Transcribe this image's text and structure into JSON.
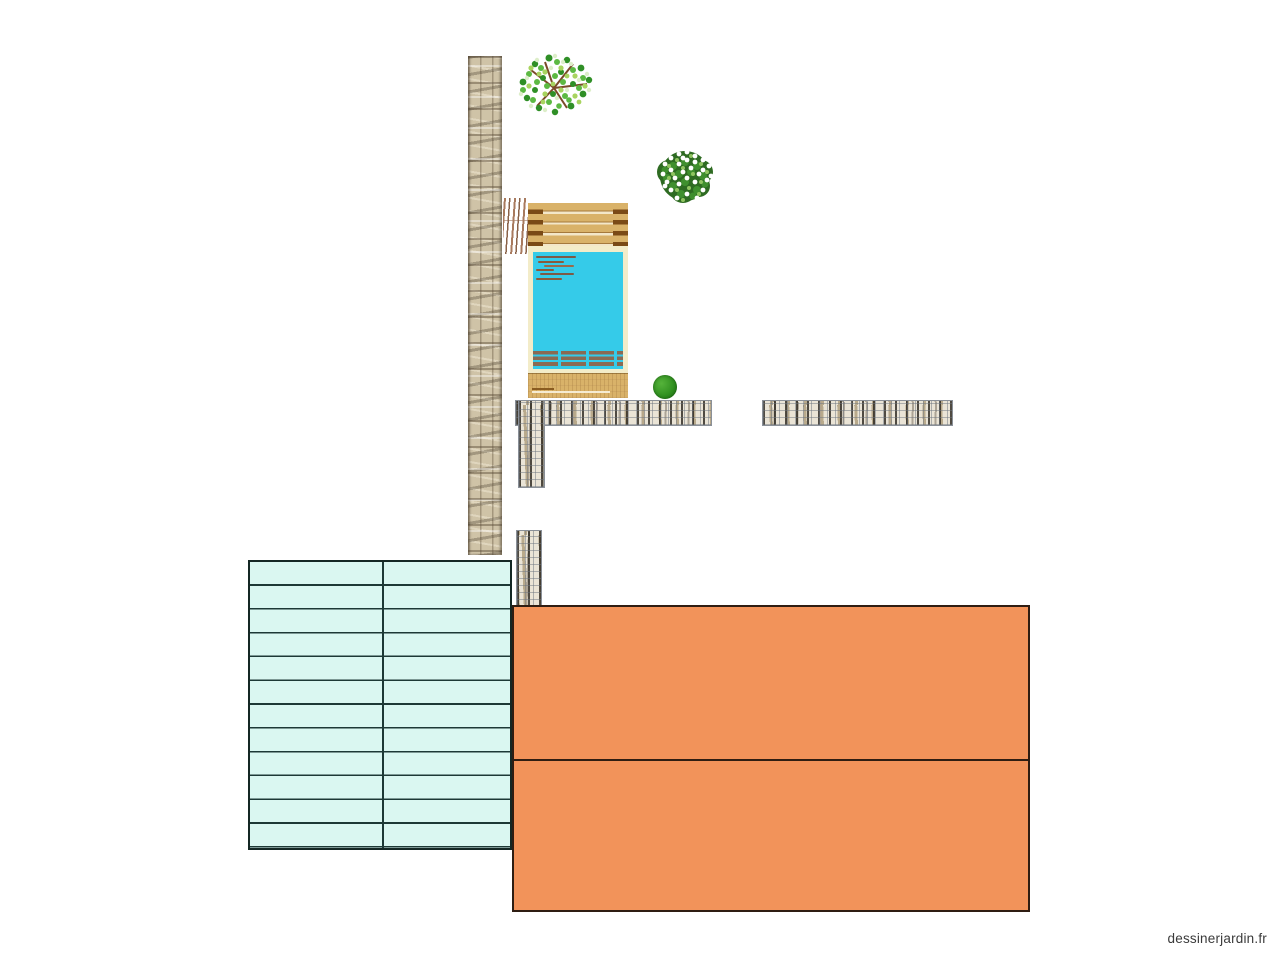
{
  "page": {
    "background": "#ffffff",
    "watermark": "dessinerjardin.fr"
  },
  "palette": {
    "orange_fill": "#f2935a",
    "orange_border": "#2f1d12",
    "mint_fill": "#daf7f1",
    "mint_line": "#1d3936",
    "pool_water": "#35cbe9",
    "pool_frame": "#f3ecc9",
    "deck_wood": "#d9b269",
    "deck_wood_dark": "#7a4a16",
    "gabion_stone": "#eae4d6",
    "gabion_mesh": "#8a9098",
    "stone_wall": "#cfc3a7",
    "tree_green": "#2f8f26",
    "shrub_green": "#2e6b22",
    "flower_white": "#ffffff",
    "bush_green": "#2f8f1f",
    "reed_brown": "#a87a5e",
    "watermark_text": "#3a3a3a"
  },
  "plan": {
    "objects": [
      {
        "id": "stone-wall",
        "kind": "dry-stone-wall-vertical"
      },
      {
        "id": "deciduous-tree",
        "kind": "tree-top-view"
      },
      {
        "id": "flowering-shrub",
        "kind": "shrub-white-flowers-top-view"
      },
      {
        "id": "reed-screen",
        "kind": "branch-screen"
      },
      {
        "id": "deck-top",
        "kind": "wood-deck"
      },
      {
        "id": "pool",
        "kind": "swimming-pool"
      },
      {
        "id": "deck-bottom",
        "kind": "wood-deck"
      },
      {
        "id": "boxwood-ball",
        "kind": "small-round-bush"
      },
      {
        "id": "gabion-left-horizontal",
        "kind": "gabion-wall"
      },
      {
        "id": "gabion-right-horizontal",
        "kind": "gabion-wall"
      },
      {
        "id": "gabion-vertical-upper",
        "kind": "gabion-wall"
      },
      {
        "id": "gabion-vertical-lower",
        "kind": "gabion-wall"
      },
      {
        "id": "plank-terrace",
        "kind": "decking-grid-2x12"
      },
      {
        "id": "terrace-upper",
        "kind": "orange-terrace"
      },
      {
        "id": "terrace-lower",
        "kind": "orange-terrace"
      }
    ]
  }
}
